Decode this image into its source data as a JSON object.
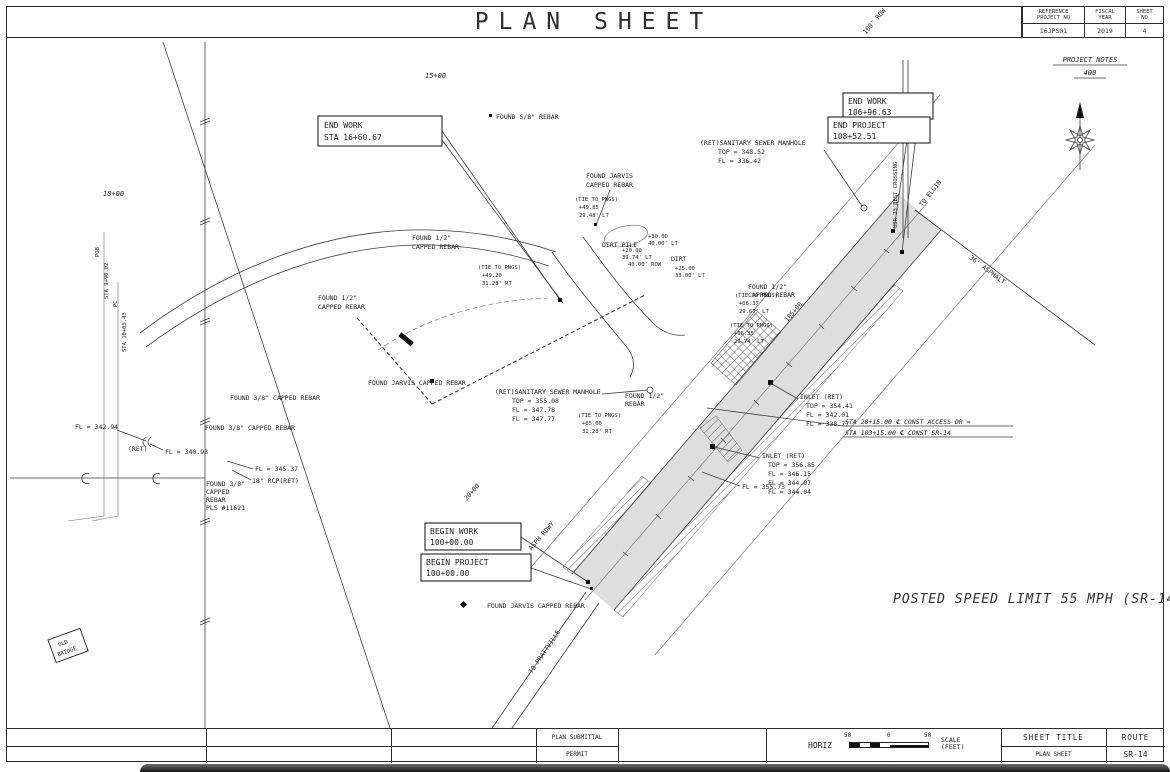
{
  "titlebar": {
    "title": "PLAN SHEET"
  },
  "info_block": {
    "ref_label1": "REFERENCE",
    "ref_label2": "PROJECT NO",
    "ref_value": "16JPS01",
    "fy_label1": "FISCAL",
    "fy_label2": "YEAR",
    "fy_value": "2019",
    "sheet_label1": "SHEET",
    "sheet_label2": "NO",
    "sheet_value": "4"
  },
  "notes": {
    "title": "PROJECT NOTES",
    "number": "400"
  },
  "footer": {
    "plan_submittal": "PLAN SUBMITTAL",
    "permit": "PERMIT",
    "horiz": "HORIZ",
    "scale_left": "50",
    "scale_mid": "0",
    "scale_right": "50",
    "scale_label1": "SCALE",
    "scale_label2": "(FEET)",
    "sheet_title_label": "SHEET TITLE",
    "sheet_title_value": "PLAN SHEET",
    "route_label": "ROUTE",
    "route_value": "SR-14"
  },
  "plan": {
    "labels": {
      "sta_15": "15+00",
      "sta_10": "10+00",
      "sta_20": "20+00",
      "sta_105": "105+00",
      "found_58": "FOUND 5/8\" REBAR",
      "found_jarvis": "FOUND JARVIS",
      "capped_rebar": "CAPPED REBAR",
      "found_jarvis_capped": "FOUND JARVIS CAPPED REBAR",
      "found_half": "FOUND 1/2\"",
      "rebar": "REBAR",
      "found_38": "FOUND 3/8\" CAPPED REBAR",
      "found_38_l1": "FOUND 3/8\"",
      "found_38_l2": "CAPPED",
      "found_38_l3": "REBAR",
      "found_38_l4": "PLS #11621",
      "san_manhole": "(RET)SANITARY SEWER MANHOLE",
      "mh1_top": "TOP = 348.52",
      "mh1_fl": "FL = 336.42",
      "mh2_top": "TOP = 355.08",
      "mh2_fl1": "FL = 347.78",
      "mh2_fl2": "FL = 347.77",
      "inlet": "INLET (RET)",
      "in1_top": "TOP = 354.41",
      "in1_fl1": "FL = 342.01",
      "in1_fl2": "FL = 338.77",
      "in2_top": "TOP = 356.85",
      "in2_fl1": "FL = 346.15",
      "in2_fl2": "FL = 344.07",
      "in2_fl3": "FL = 344.04",
      "fl_355": "FL = 355.73",
      "fl_342": "FL = 342.94",
      "fl_340": "FL = 340.93",
      "ret": "(RET)",
      "fl_345": "FL = 345.37",
      "rcp_18": "18\" RCP(RET)",
      "end_work": "END WORK",
      "end_work_sta": "STA 16+60.67",
      "end_work_sta2": "106+96.63",
      "end_project": "END PROJECT",
      "end_project_sta": "108+52.51",
      "begin_work": "BEGIN WORK",
      "begin_project": "BEGIN PROJECT",
      "begin_sta": "100+00.00",
      "sta_const_1": "STA 20+15.00 ℄ CONST ACCESS DR =",
      "sta_const_2": "STA 103+15.00 ℄ CONST SR-14",
      "dirt_pile": "DIRT PILE",
      "dirt": "DIRT",
      "tie": "(TIE TO PNGS)",
      "tie_a2": "+49.85",
      "tie_a3": "29.48' LT",
      "tie_b2": "+06.37",
      "tie_b3": "29.67' LT",
      "tie_c2": "+06.35",
      "tie_c3": "29.74' LT",
      "tie_d2": "+05.00",
      "tie_d3": "31.28' RT",
      "tie_e2": "+49.20",
      "tie_e3": "31.28' RT",
      "off_a1": "+20.00",
      "off_a2": "39.74' LT",
      "off_b1": "+30.00",
      "off_b2": "40.00' LT",
      "off_c1": "+25.00",
      "off_c2": "33.00' LT",
      "row_40": "40.00' ROW",
      "row_100": "100' ROW",
      "posted_speed": "POSTED SPEED LIMIT 55 MPH (SR-14)",
      "old_bridge_1": "OLD",
      "old_bridge_2": "BRIDGE",
      "to_elgin": "TO ELGIN",
      "to_prattville": "TO PRATTVILLE",
      "best_crossing": "USR 73 BEST CROSSING",
      "asphalt_36": "36' ASPHALT",
      "asph_rdwy": "ASPH RDWY",
      "pob": "POB",
      "pob_sta": "STA 9+90.02",
      "pc": "PC",
      "pc_sta": "STA 10+03.43"
    }
  }
}
